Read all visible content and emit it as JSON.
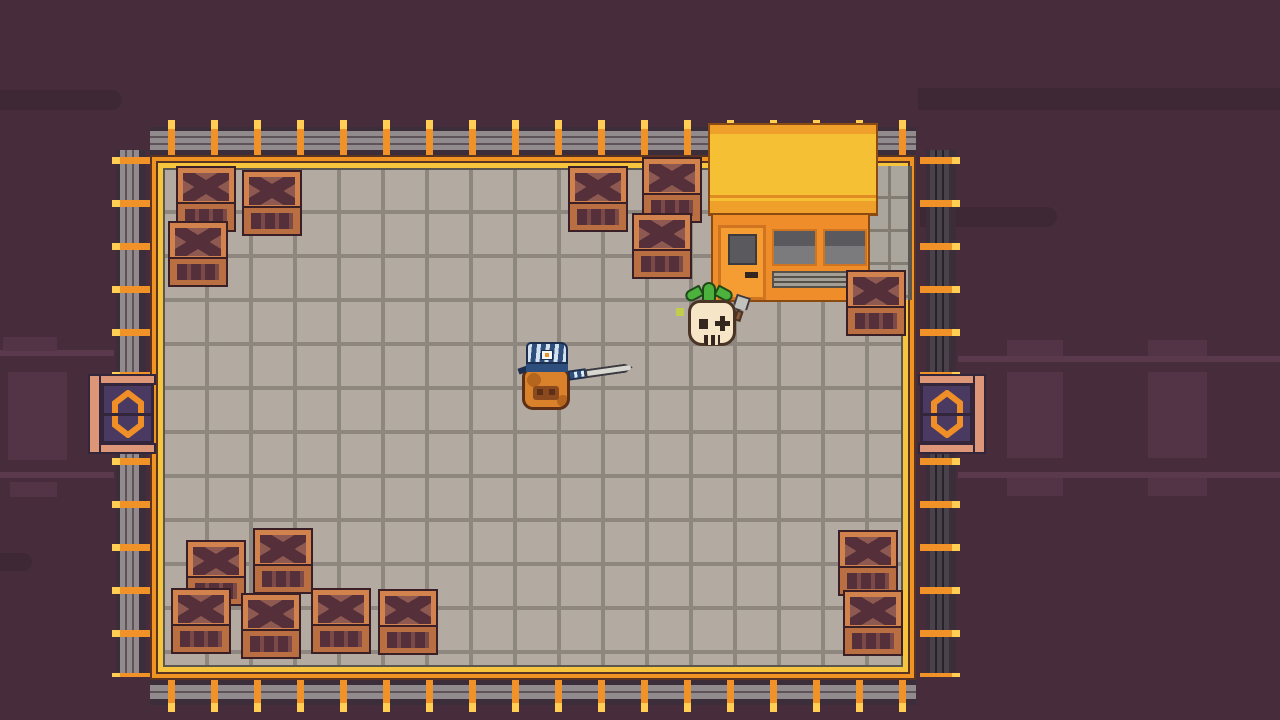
{
  "colors": {
    "bg": "#472d3b",
    "decor-dark": "#3f2836",
    "decor-light": "#533447",
    "decor-line": "#5a394c",
    "fence-orange": "#f09227",
    "fence-yellow": "#ffce53",
    "rail-light": "#918b8e",
    "rail-dark": "#5e5359",
    "rail-shadow": "#4a424b",
    "rail-shadow-dark": "#27222b",
    "rail-backdrop": "#3b2d3a",
    "border-orange": "#ef9322",
    "border-yellow": "#f7c53d",
    "border-line": "#5a3420",
    "tile": "#b3aaa1",
    "grout": "#8e8780",
    "tile-edge": "#5b564f",
    "roof-yellow": "#f5c033",
    "roof-band": "#efa02b",
    "roof-band2": "#e08c22",
    "roof-outline": "#8a4a12",
    "facade": "#ef8d2a",
    "door": "#f59d33",
    "door-frame": "#cf7420",
    "window-dark": "#5a595e",
    "window-light": "#7b7b7d",
    "wall": "#aba69d",
    "wall-grout": "#837c72",
    "bench": "#a39f95",
    "bench-dark": "#55504a",
    "gate-salmon": "#dd9677",
    "gate-navy": "#4a3a61",
    "gate-outline": "#33253a",
    "gate-symbol": "#f08e28",
    "crate-frame": "#d2824d",
    "crate-front-frame": "#b96f42",
    "crate-panel": "#8d5950",
    "crate-x": "#55303a",
    "crate-front": "#7b4a48",
    "crate-outline": "#3a2026",
    "player-body": "#d9822b",
    "player-shade": "#b5651d",
    "player-outline": "#5c2f16",
    "player-face": "#8a4a1d",
    "cap-blue": "#2e4e7e",
    "cap-outline": "#1c2f4e",
    "blade": "#d8d8d2",
    "blade-outline": "#3c3a40",
    "enemy-skin": "#f6e5c6",
    "enemy-outline": "#4a3426",
    "enemy-dark": "#33261f",
    "leaf-green": "#4cb13d",
    "leaf-outline": "#1e4a1a",
    "knife-gray": "#c2c2bc",
    "knife-handle": "#8a5a3a",
    "glow": "#c2cc4e"
  },
  "sprites": {
    "player": "capped-creature-with-sword",
    "enemy": "sprout-skull-with-cleaver",
    "crate": "wooden-crate-x-pattern",
    "gate": "hexagon-sliding-door",
    "building": "orange-shop-with-yellow-roof"
  },
  "entities": {
    "player": {
      "x": 516,
      "y": 336,
      "facing": "right"
    },
    "enemy": {
      "x": 674,
      "y": 282,
      "facing": "left"
    }
  },
  "crates": [
    {
      "x": 178,
      "y": 168
    },
    {
      "x": 244,
      "y": 172
    },
    {
      "x": 170,
      "y": 223
    },
    {
      "x": 570,
      "y": 168
    },
    {
      "x": 644,
      "y": 159
    },
    {
      "x": 634,
      "y": 215
    },
    {
      "x": 848,
      "y": 272
    },
    {
      "x": 188,
      "y": 542
    },
    {
      "x": 255,
      "y": 530
    },
    {
      "x": 173,
      "y": 590
    },
    {
      "x": 243,
      "y": 595
    },
    {
      "x": 313,
      "y": 590
    },
    {
      "x": 380,
      "y": 591
    },
    {
      "x": 840,
      "y": 532
    },
    {
      "x": 845,
      "y": 592
    }
  ],
  "gates": [
    {
      "side": "left",
      "x": 88,
      "y": 367
    },
    {
      "side": "right",
      "x": 916,
      "y": 367
    }
  ],
  "building": {
    "x": 708,
    "y": 123
  }
}
